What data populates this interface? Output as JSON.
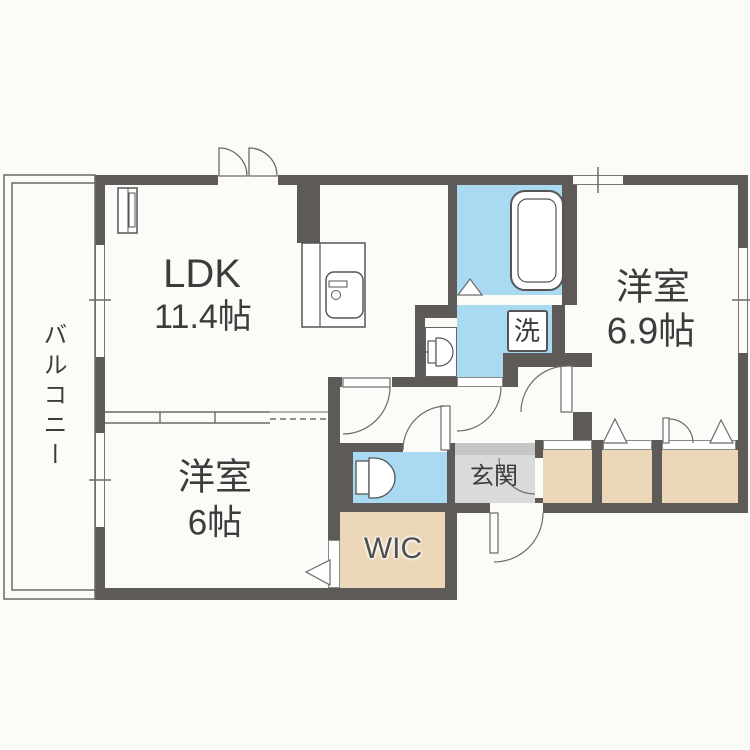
{
  "floorplan": {
    "type": "apartment-floor-plan",
    "rooms": {
      "balcony": {
        "label": "バルコニー"
      },
      "ldk": {
        "label": "LDK",
        "area": "11.4帖"
      },
      "bedroom_right": {
        "label": "洋室",
        "area": "6.9帖"
      },
      "bedroom_left": {
        "label": "洋室",
        "area": "6帖"
      },
      "entrance": {
        "label": "玄関"
      },
      "walk_in_closet": {
        "label": "WIC"
      },
      "laundry": {
        "label": "洗"
      }
    },
    "colors": {
      "wall": "#5d5a57",
      "water_area": "#a9daf2",
      "storage": "#ebd7b8",
      "entrance_floor": "#dadada",
      "entrance_step": "#c6c6c6",
      "background": "#fbfbf8",
      "line": "#6b6b6b",
      "text": "#3c3c3c"
    }
  }
}
